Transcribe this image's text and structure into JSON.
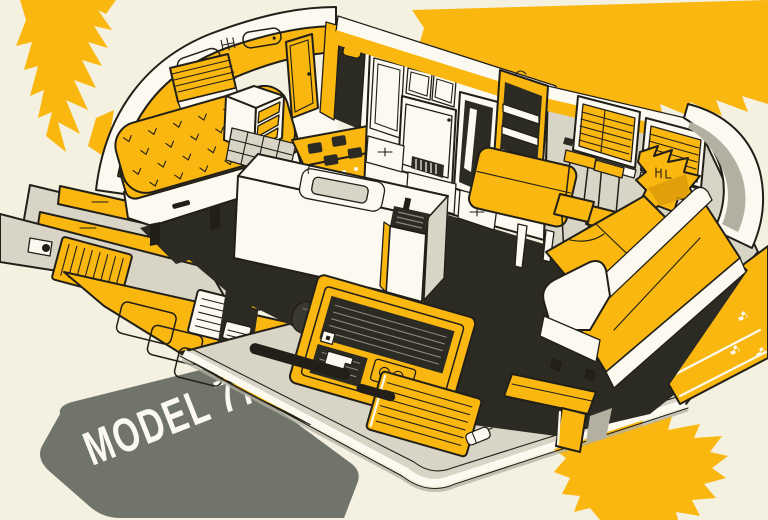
{
  "illustration": {
    "caption": "MODEL 77",
    "description": "cutaway interior illustration of a Model 77 travel trailer"
  },
  "palette": {
    "paper": "#f5f1e1",
    "accent-yellow": "#f9b70f",
    "yellow-deep": "#dd9b08",
    "ink": "#211f18",
    "interior-dark": "#2b2a23",
    "panel-white": "#fcfaf0",
    "light-gray": "#d8d5c6",
    "mid-gray": "#b3b0a1",
    "shadow-gray": "#70746b"
  }
}
